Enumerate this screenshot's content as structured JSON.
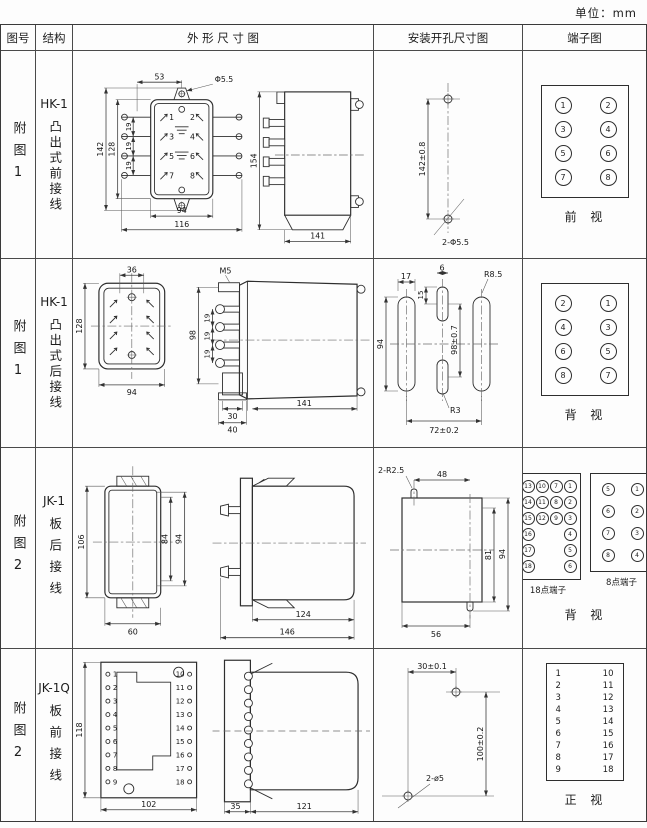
{
  "page": {
    "unit_label": "单位：mm"
  },
  "headers": {
    "fig_no": "图号",
    "structure": "结构",
    "outline": "外 形 尺 寸 图",
    "mounting": "安装开孔尺寸图",
    "terminal": "端子图"
  },
  "rows": [
    {
      "fig_no": "附图1",
      "model": "HK-1",
      "wiring": "凸出式前接线",
      "outline": {
        "dim_top_width": "53",
        "dim_ear_hole": "Φ5.5",
        "dim_total_h": "142",
        "dim_body_h": "128",
        "dim_pitch1": "19",
        "dim_pitch2": "19",
        "dim_pitch3": "19",
        "dim_body_w": "94",
        "dim_total_w": "116",
        "pins": [
          "1",
          "2",
          "3",
          "4",
          "5",
          "6",
          "7",
          "8"
        ],
        "dim_side_h": "154",
        "dim_side_w": "141"
      },
      "mounting": {
        "dim_v": "142±0.8",
        "holes": "2-Φ5.5"
      },
      "terminal": {
        "cells": [
          "1",
          "2",
          "3",
          "4",
          "5",
          "6",
          "7",
          "8"
        ],
        "view": "前  视"
      }
    },
    {
      "fig_no": "附图1",
      "model": "HK-1",
      "wiring": "凸出式后接线",
      "outline": {
        "dim_top_width": "36",
        "dim_body_h": "128",
        "dim_body_w": "94",
        "screw": "M5",
        "dim_stud_h": "98",
        "dim_pitch1": "19",
        "dim_pitch2": "19",
        "dim_pitch3": "19",
        "dim_w30": "30",
        "dim_w40": "40",
        "dim_side_w": "141"
      },
      "mounting": {
        "dim_slot_w": "17",
        "dim_slot6": "6",
        "dim_slot15": "15",
        "dim_h94": "94",
        "dim_v": "98±0.7",
        "r_big": "R8.5",
        "r_small": "R3",
        "dim_span": "72±0.2"
      },
      "terminal": {
        "cells": [
          "2",
          "1",
          "4",
          "3",
          "6",
          "5",
          "8",
          "7"
        ],
        "view": "背  视"
      }
    },
    {
      "fig_no": "附图2",
      "model": "JK-1",
      "wiring": "板后接线",
      "outline": {
        "dim_h106": "106",
        "dim_h84": "84",
        "dim_h94": "94",
        "dim_w60": "60",
        "dim_w124": "124",
        "dim_w146": "146"
      },
      "mounting": {
        "r": "2-R2.5",
        "dim_top": "48",
        "dim_h81": "81",
        "dim_h94": "94",
        "dim_bottom": "56"
      },
      "terminal": {
        "grid18": [
          "13",
          "10",
          "7",
          "1",
          "14",
          "11",
          "8",
          "2",
          "15",
          "12",
          "9",
          "3",
          "16",
          "",
          "",
          "4",
          "17",
          "",
          "",
          "5",
          "18",
          "",
          "",
          "6"
        ],
        "grid8": [
          "5",
          "1",
          "6",
          "2",
          "7",
          "3",
          "8",
          "4"
        ],
        "label18": "18点端子",
        "label8": "8点端子",
        "view": "背  视"
      }
    },
    {
      "fig_no": "附图2",
      "model": "JK-1Q",
      "wiring": "板前接线",
      "outline": {
        "dim_h118": "118",
        "dim_w102": "102",
        "left_pins": [
          "1",
          "2",
          "3",
          "4",
          "5",
          "6",
          "7",
          "8",
          "9"
        ],
        "right_pins": [
          "10",
          "11",
          "12",
          "13",
          "14",
          "15",
          "16",
          "17",
          "18"
        ],
        "dim_w35": "35",
        "dim_w121": "121"
      },
      "mounting": {
        "dim_top": "30±0.1",
        "dim_v": "100±0.2",
        "holes": "2-ø5"
      },
      "terminal": {
        "left": [
          "1",
          "2",
          "3",
          "4",
          "5",
          "6",
          "7",
          "8",
          "9"
        ],
        "right": [
          "10",
          "11",
          "12",
          "13",
          "14",
          "15",
          "16",
          "17",
          "18"
        ],
        "view": "正  视"
      }
    }
  ]
}
